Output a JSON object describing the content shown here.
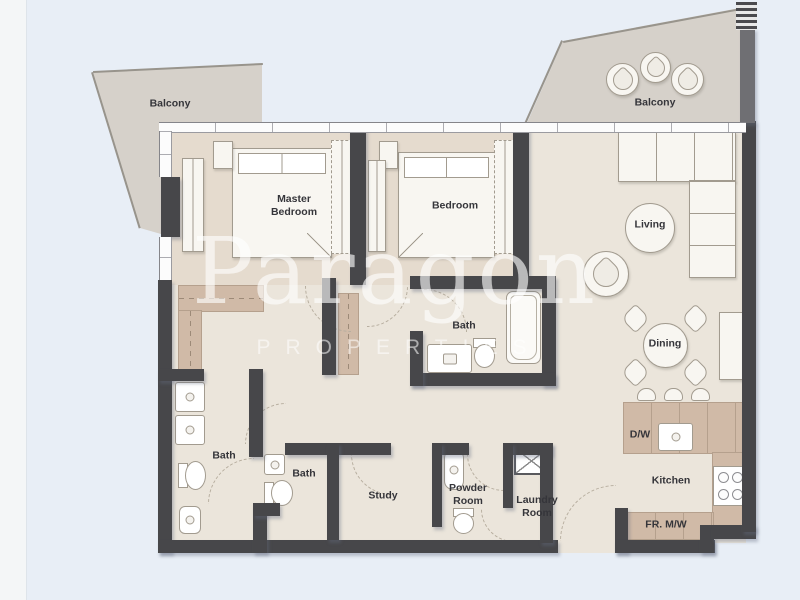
{
  "watermark": {
    "brand": "Paragon",
    "tagline": "PROPERTIES"
  },
  "labels": {
    "balcony_left": "Balcony",
    "balcony_right": "Balcony",
    "master_bedroom": "Master Bedroom",
    "bedroom": "Bedroom",
    "living": "Living",
    "dining": "Dining",
    "bath_left": "Bath",
    "bath_middle": "Bath",
    "bath_right": "Bath",
    "study": "Study",
    "powder_room": "Powder Room",
    "laundry_room": "Laundry Room",
    "kitchen": "Kitchen",
    "dishwasher": "D/W",
    "fridge_microwave": "FR. M/W"
  },
  "colors": {
    "bg": "#e8eef6",
    "panel": "#f4f6f7",
    "wall": "#47474a",
    "wall_light": "#6f6f73",
    "floor": "#ebe5db",
    "balcony": "#d6d1ca",
    "closet": "#d0baa7",
    "furniture": "#f8f6f1",
    "line": "#a29b8f",
    "label": "#35353a",
    "watermark": "#ffffff"
  }
}
